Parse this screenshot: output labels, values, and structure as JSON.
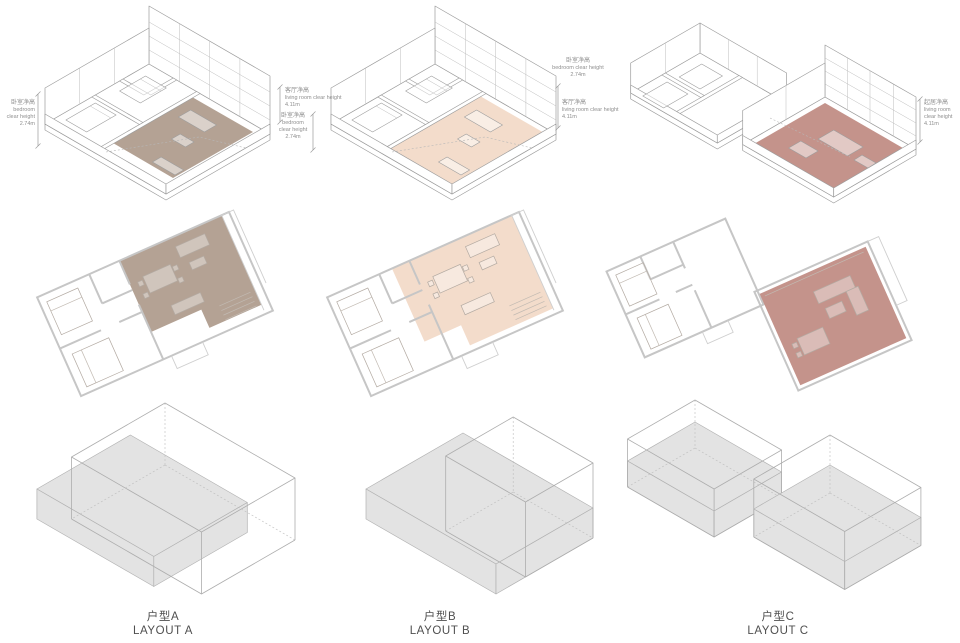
{
  "page": {
    "background": "#ffffff"
  },
  "columns": [
    {
      "id": "A",
      "caption_zh": "户型A",
      "caption_en": "LAYOUT A",
      "highlight": "#b4a294"
    },
    {
      "id": "B",
      "caption_zh": "户型B",
      "caption_en": "LAYOUT B",
      "highlight": "#f3dccb"
    },
    {
      "id": "C",
      "caption_zh": "户型C",
      "caption_en": "LAYOUT C",
      "highlight": "#c4938b"
    }
  ],
  "annotations": {
    "a_left": {
      "zh": "卧室净高",
      "en1": "bedroom",
      "en2": "clear height",
      "value": "2.74m"
    },
    "a_living": {
      "zh": "客厅净高",
      "en1": "living room clear height",
      "value": "4.11m"
    },
    "a_bedroom": {
      "zh": "卧室净高",
      "en1": "bedroom",
      "en2": "clear height",
      "value": "2.74m"
    },
    "b_bedroom": {
      "zh": "卧室净高",
      "en1": "bedroom clear height",
      "value": "2.74m"
    },
    "b_living": {
      "zh": "客厅净高",
      "en1": "living room clear height",
      "value": "4.11m"
    },
    "c_living": {
      "zh": "起居净高",
      "en1": "living room",
      "en2": "clear height",
      "value": "4.11m"
    }
  },
  "colors": {
    "massing_fill": "#e3e3e3",
    "line": "#9d9d9d",
    "plan_line": "#c6c6c6",
    "annotation_text": "#8f8f8f",
    "caption_text": "#4f4f4f"
  }
}
